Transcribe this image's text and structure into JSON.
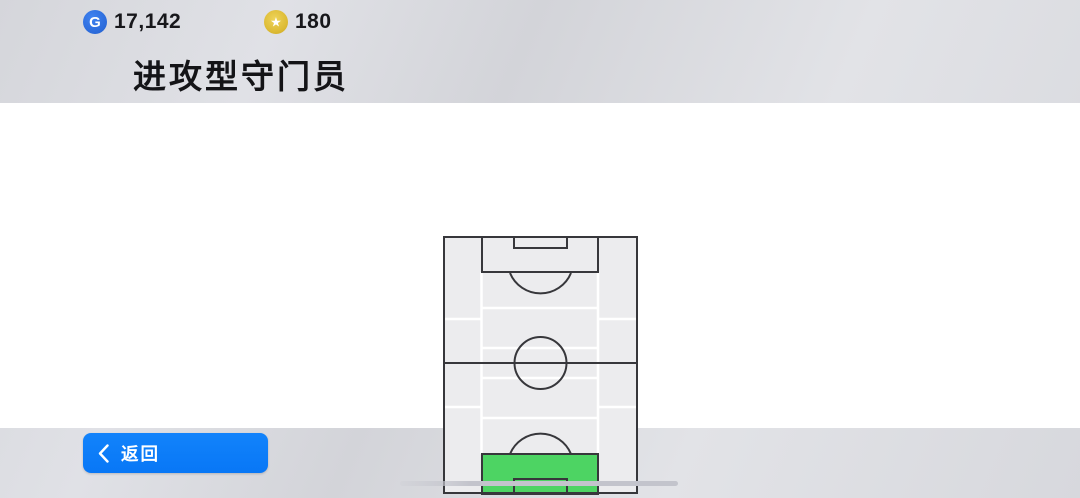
{
  "header": {
    "gp": {
      "icon": "g-coin-icon",
      "letter": "G",
      "value": "17,142"
    },
    "coins": {
      "icon": "star-coin-icon",
      "star": "★",
      "value": "180"
    },
    "title": "进攻型守门员"
  },
  "pitch": {
    "description": "vertical-soccer-pitch-position-map",
    "highlighted_position": "goalkeeper-penalty-area",
    "highlight_color": "#4dd463",
    "line_color": "#37373b",
    "cell_color": "#ececee",
    "zone_line_color": "#ffffff"
  },
  "footer": {
    "back_label": "返回"
  }
}
